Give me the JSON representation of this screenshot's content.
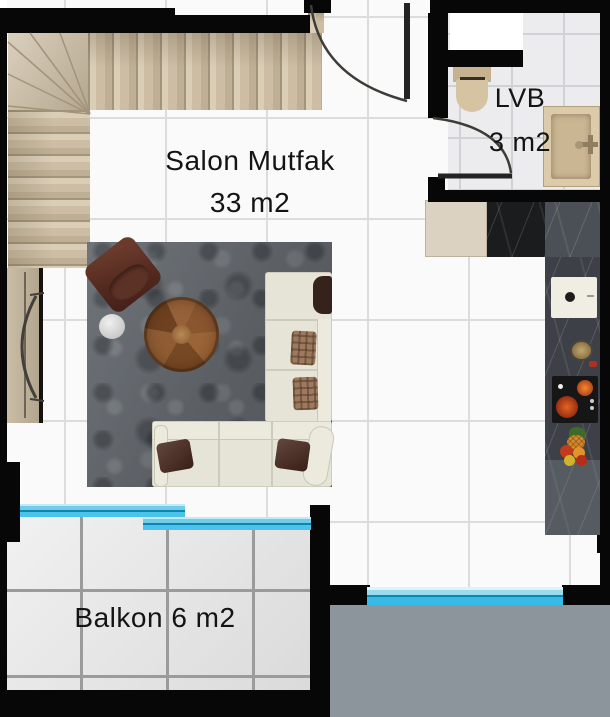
{
  "plan_title": "apartment-floor-plan",
  "rooms": {
    "salon": {
      "name": "Salon Mutfak",
      "area": "33 m2"
    },
    "lvb": {
      "name": "LVB",
      "area": "3 m2"
    },
    "balkon": {
      "label": "Balkon 6 m2"
    }
  },
  "fixtures": [
    "staircase",
    "entrance-door",
    "bathroom-door",
    "toilet",
    "washbasin",
    "duct-niche",
    "fridge",
    "kitchen-counter",
    "kitchen-sink",
    "stove",
    "decor-plate",
    "fruit-basket",
    "sofa",
    "armchair",
    "coffee-table",
    "side-table",
    "rug",
    "console",
    "balcony-window",
    "lower-balcony"
  ],
  "colors": {
    "wall": "#070707",
    "floor_tile": "#fafafa",
    "window_glass": "#35bbe5",
    "window_glass_dark": "#0f84ad",
    "stairs": "#cec0a8",
    "rug": "#676c72",
    "sofa": "#e6e4d7",
    "wood_table": "#8a5630",
    "kitchen_counter": "#3d4147",
    "bathroom_fixture": "#d6c3a1",
    "balcony_tile": "#e3e3e3",
    "lower_balcony": "#8d959c",
    "label_text": "#141414"
  }
}
